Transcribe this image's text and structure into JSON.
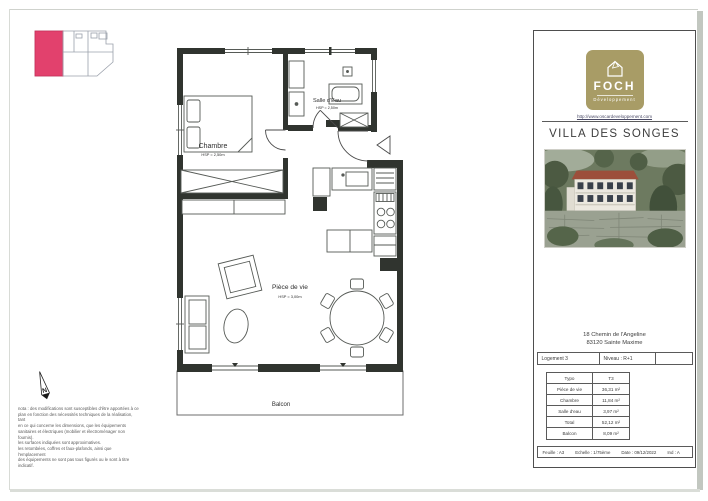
{
  "colors": {
    "unit_highlight": "#e2416d",
    "logo_background": "#a89c66",
    "wall": "#30342f"
  },
  "north": {
    "label": "N"
  },
  "plan": {
    "chambre": {
      "label": "Chambre",
      "hsp": "HSP = 2,50m"
    },
    "salle_eau": {
      "label": "Salle d'Eau",
      "hsp": "HSP = 2,50m"
    },
    "piece_vie": {
      "label": "Pièce de vie",
      "hsp": "HSP = 3,00m"
    },
    "balcon": {
      "label": "Balcon"
    }
  },
  "note": {
    "lines": [
      "nota : des modifications sont susceptibles d'être apportées à ce",
      "plan en fonction des nécessités techniques de la réalisation, tant",
      "en ce qui concerne les dimensions, que les équipements",
      "sanitaires et électriques (mobilier et électroménager non fournis).",
      "les surfaces indiquées sont approximatives.",
      "les retombées, coffres et faux-plafonds, ainsi que l'emplacement",
      "des équipements ne sont pas tous figurés ou le sont à titre",
      "indicatif."
    ]
  },
  "panel": {
    "brand": "FOCH",
    "brand_subtitle": "Développement",
    "website": "http://www.oscardeveloppement.com",
    "project_title": "VILLA DES SONGES",
    "address_line1": "18 Chemin de l'Angeline",
    "address_line2": "83120 Sainte Maxime",
    "unit": "Logement 3",
    "level": "Niveau : R+1",
    "surfaces": {
      "rows": [
        {
          "label": "Typo",
          "value": "T3"
        },
        {
          "label": "Pièce de vie",
          "value": "36,31 m²"
        },
        {
          "label": "Chambre",
          "value": "11,84 m²"
        },
        {
          "label": "Salle d'eau",
          "value": "3,97 m²"
        },
        {
          "label": "Total",
          "value": "52,12 m²"
        },
        {
          "label": "Balcon",
          "value": "8,09 m²"
        }
      ]
    },
    "sheet": "Feuille : A3",
    "scale": "Echelle : 1/75ème",
    "date": "Date : 09/12/2022",
    "index": "Ind : A"
  }
}
